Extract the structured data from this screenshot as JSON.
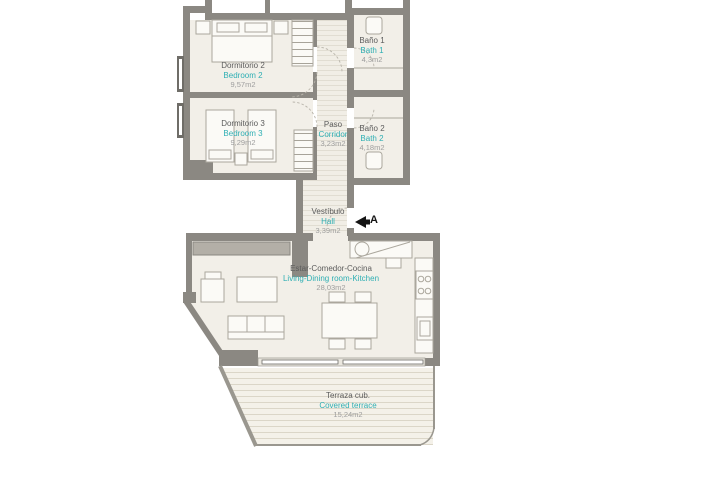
{
  "plan": {
    "rooms": [
      {
        "id": "bedroom-2",
        "name_es": "Dormitorio 2",
        "name_en": "Bedroom 2",
        "area": "9,57m2"
      },
      {
        "id": "bedroom-3",
        "name_es": "Dormitorio 3",
        "name_en": "Bedroom 3",
        "area": "9,29m2"
      },
      {
        "id": "bath-1",
        "name_es": "Baño 1",
        "name_en": "Bath 1",
        "area": "4,3m2"
      },
      {
        "id": "bath-2",
        "name_es": "Baño 2",
        "name_en": "Bath 2",
        "area": "4,18m2"
      },
      {
        "id": "corridor",
        "name_es": "Paso",
        "name_en": "Corridor",
        "area": "3,23m2"
      },
      {
        "id": "hall",
        "name_es": "Vestíbulo",
        "name_en": "Hall",
        "area": "3,39m2"
      },
      {
        "id": "living",
        "name_es": "Estar-Comedor-Cocina",
        "name_en": "Living-Dining room-Kitchen",
        "area": "28,03m2"
      },
      {
        "id": "terrace",
        "name_es": "Terraza cub.",
        "name_en": "Covered terrace",
        "area": "15,24m2"
      }
    ],
    "entrance": {
      "label": "A"
    },
    "colors": {
      "accent_teal": "#2FAFB4",
      "room_name_gray": "#5C5C5C",
      "area_gray": "#9E9E9E",
      "wall_gray": "#8B8882",
      "floor_cream": "#F2EFE8"
    }
  }
}
